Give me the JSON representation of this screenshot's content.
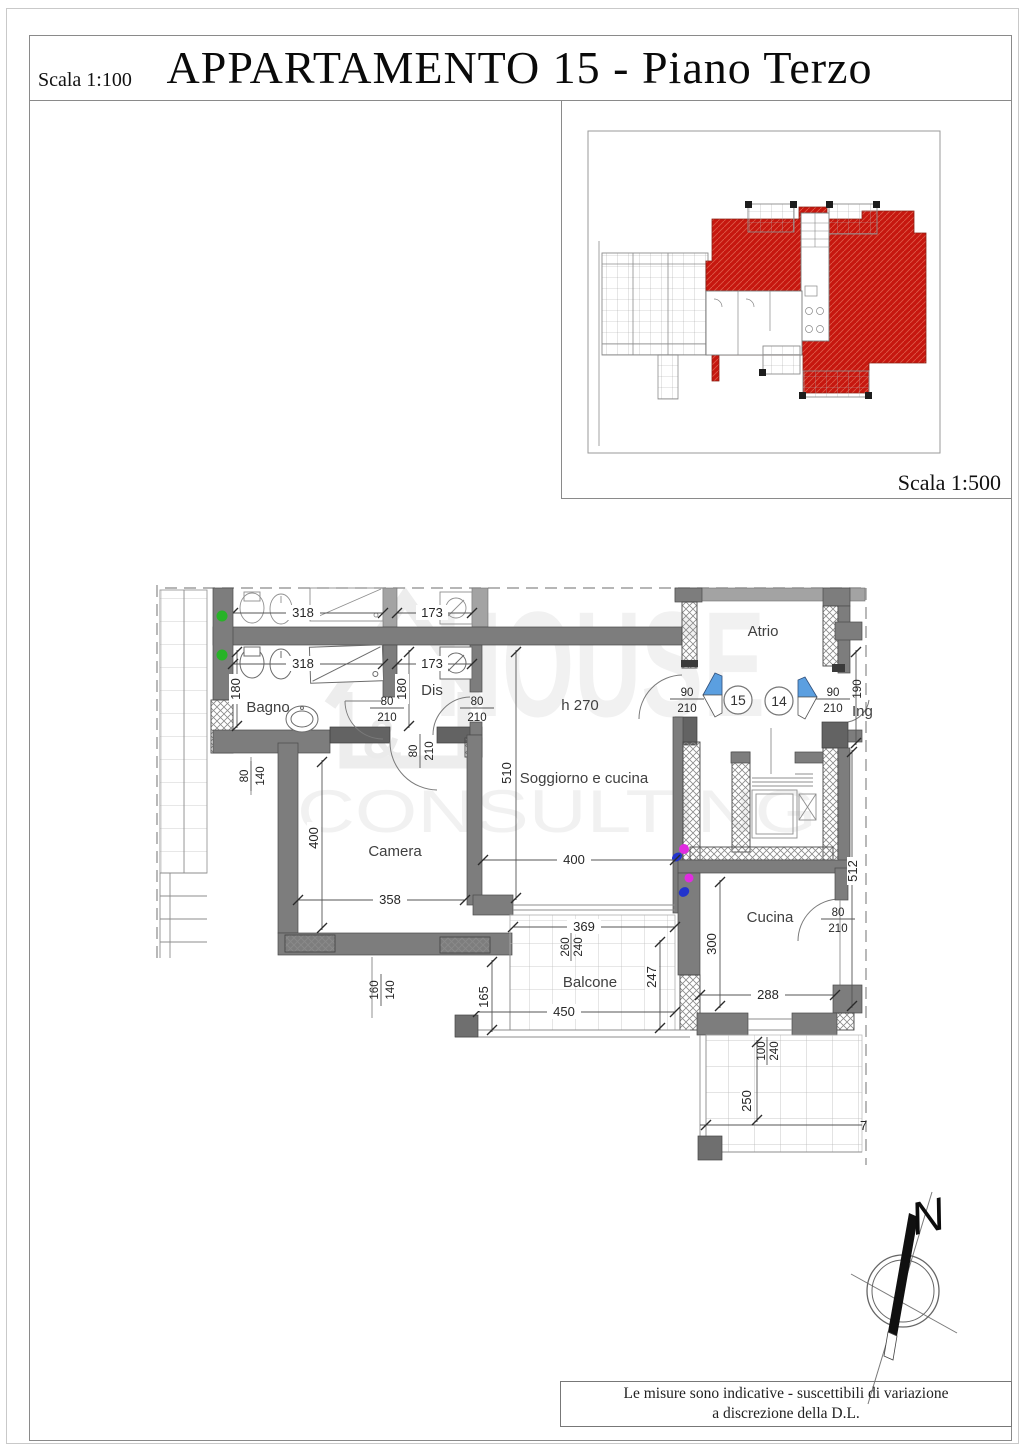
{
  "page": {
    "title": "APPARTAMENTO 15 - Piano Terzo",
    "scale_main": "Scala 1:100",
    "scale_key": "Scala 1:500",
    "footer_line1": "Le misure sono indicative - suscettibili di variazione",
    "footer_line2": "a discrezione della D.L."
  },
  "watermark": {
    "amp": "&",
    "word1": "HOUSE",
    "word2": "CONSULTING"
  },
  "compass": {
    "north": "N"
  },
  "plan": {
    "rooms": {
      "bagno": "Bagno",
      "dis": "Dis",
      "soggiorno": "Soggiorno e cucina",
      "atrio": "Atrio",
      "camera": "Camera",
      "cucina": "Cucina",
      "balcone": "Balcone"
    },
    "height_note": "h 270",
    "entrance": "Ing",
    "units": {
      "left": "15",
      "right": "14"
    },
    "dims": {
      "d318": "318",
      "d173": "173",
      "d180": "180",
      "d510": "510",
      "d400": "400",
      "d358": "358",
      "d369": "369",
      "d450": "450",
      "d165": "165",
      "d247": "247",
      "d300": "300",
      "d288": "288",
      "d250": "250",
      "d190": "190",
      "d512": "512",
      "d7": "7",
      "w80": "80",
      "w90": "90",
      "w100": "100",
      "w140": "140",
      "w160": "160",
      "w210": "210",
      "w240": "240",
      "w260": "260"
    }
  },
  "colors": {
    "apartment_highlight": "#c6170f",
    "wall_gray": "#7d7d7d",
    "door_marker_blue": "#5b9fe0",
    "riser_green": "#27b327",
    "riser_magenta": "#e02ce0",
    "riser_blue": "#2233cc"
  }
}
